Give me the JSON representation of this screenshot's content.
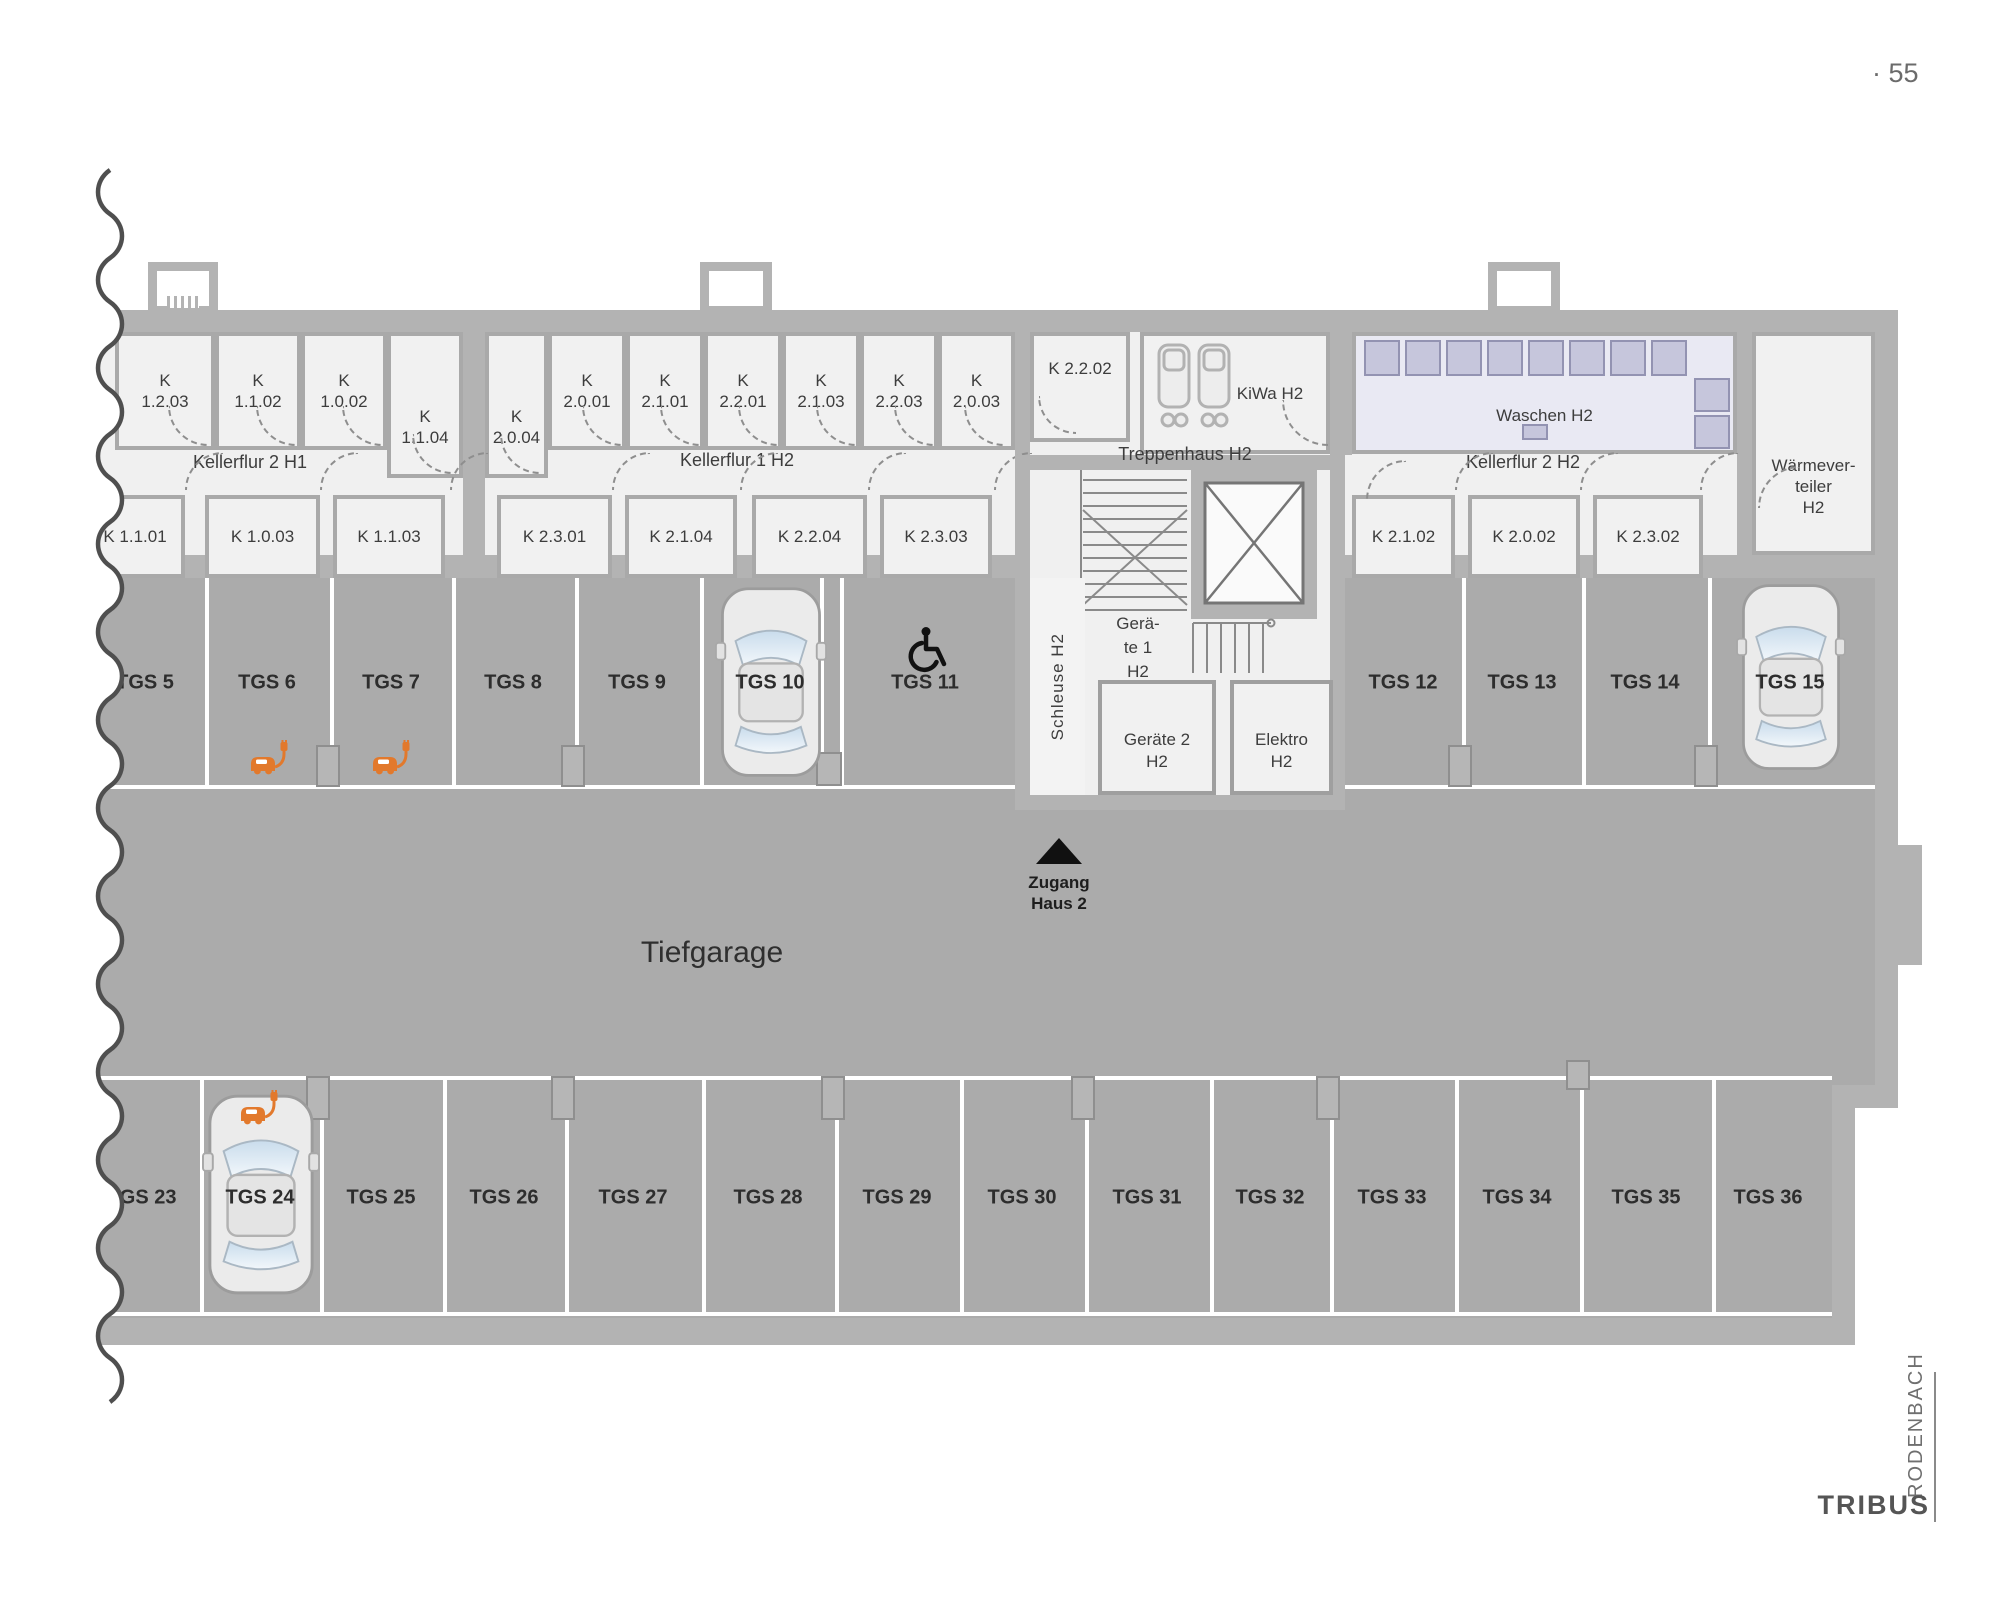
{
  "page": {
    "number": "· 55"
  },
  "brand": {
    "name": "TRIBUS",
    "location": "RODENBACH"
  },
  "plan": {
    "title": "Tiefgarage",
    "entrance": {
      "line1": "Zugang",
      "line2": "Haus 2"
    },
    "corridors": {
      "h1": "Kellerflur 2 H1",
      "h2a": "Kellerflur 1 H2",
      "stair": "Treppenhaus H2",
      "h2b": "Kellerflur 2 H2"
    },
    "rooms": {
      "row1": [
        {
          "l1": "K",
          "l2": "1.2.03"
        },
        {
          "l1": "K",
          "l2": "1.1.02"
        },
        {
          "l1": "K",
          "l2": "1.0.02"
        },
        {
          "l1": "K",
          "l2": "1.1.04"
        },
        {
          "l1": "K",
          "l2": "2.0.04"
        },
        {
          "l1": "K",
          "l2": "2.0.01"
        },
        {
          "l1": "K",
          "l2": "2.1.01"
        },
        {
          "l1": "K",
          "l2": "2.2.01"
        },
        {
          "l1": "K",
          "l2": "2.1.03"
        },
        {
          "l1": "K",
          "l2": "2.2.03"
        },
        {
          "l1": "K",
          "l2": "2.0.03"
        }
      ],
      "row2": [
        "K 1.1.01",
        "K 1.0.03",
        "K 1.1.03",
        "K 2.3.01",
        "K 2.1.04",
        "K 2.2.04",
        "K 2.3.03",
        "K 2.1.02",
        "K 2.0.02",
        "K 2.3.02"
      ],
      "k2202": "K 2.2.02",
      "kiwa": "KiWa H2",
      "waschen": "Waschen H2",
      "waermeverteiler": [
        "Wärmever-",
        "teiler",
        "H2"
      ],
      "geraete1": [
        "Gerä-",
        "te 1",
        "H2"
      ],
      "schleuse": "Schleuse H2",
      "geraete2": [
        "Geräte 2",
        "H2"
      ],
      "elektro": [
        "Elektro",
        "H2"
      ]
    },
    "parking": {
      "top": [
        "TGS 5",
        "TGS 6",
        "TGS 7",
        "TGS 8",
        "TGS 9",
        "TGS 10",
        "TGS 11",
        "TGS 12",
        "TGS 13",
        "TGS 14",
        "TGS 15"
      ],
      "bottom": [
        "TGS 23",
        "TGS 24",
        "TGS 25",
        "TGS 26",
        "TGS 27",
        "TGS 28",
        "TGS 29",
        "TGS 30",
        "TGS 31",
        "TGS 32",
        "TGS 33",
        "TGS 34",
        "TGS 35",
        "TGS 36"
      ]
    },
    "features": {
      "ev_spots": [
        "TGS 6",
        "TGS 7",
        "TGS 24"
      ],
      "accessible_spot": "TGS 11",
      "cars_parked": [
        "TGS 10",
        "TGS 15",
        "TGS 24"
      ]
    },
    "colors": {
      "wall": "#b3b3b3",
      "room": "#f1f1f1",
      "garage": "#ababab",
      "laundry": "#e9e9f3",
      "machine": "#c6c6dc",
      "ev_orange": "#e2792c",
      "text": "#3d3d3d"
    }
  }
}
